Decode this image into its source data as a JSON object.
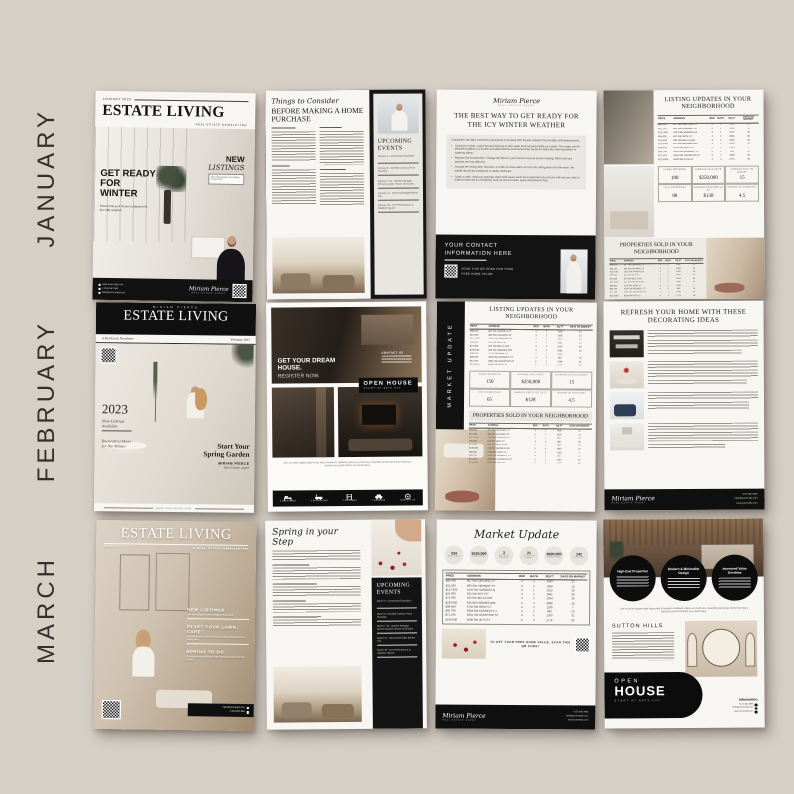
{
  "colors": {
    "background": "#d6cfc6",
    "ink": "#161616",
    "page": "#f8f6f3",
    "panel": "#e9e6e1"
  },
  "months": [
    "JANUARY",
    "FEBRUARY",
    "MARCH"
  ],
  "agent": {
    "name": "MIRIAM PIERCE",
    "signature": "Miriam Pierce",
    "title": "REAL ESTATE AGENT",
    "email": "hello@yourrealty.com",
    "phone": "+1234 567 890",
    "phone_alt": "+123 456 7890",
    "website": "www.yourrealty.com"
  },
  "table": {
    "headers": [
      "PRICE",
      "ADDRESS",
      "BED",
      "BATH",
      "SQ FT",
      "DAYS ON MARKET"
    ],
    "rows": [
      [
        "$89,000",
        "807 SW CENTRAL CT",
        "3",
        "2",
        "1400",
        "21"
      ],
      [
        "$61,200",
        "890 SW HIGHWAY ST",
        "3",
        "2",
        "1658",
        "15"
      ],
      [
        "$127,000",
        "1520 SW VARGAS LN",
        "3",
        "1",
        "1912",
        "20"
      ],
      [
        "$45,000",
        "622 SW 39TH ST",
        "4",
        "2",
        "2661",
        "30"
      ],
      [
        "$74,300",
        "920 SW BELLS AVE",
        "3",
        "2",
        "1034",
        "28"
      ],
      [
        "$230,000",
        "810 SW HERMES AVE",
        "3",
        "4",
        "3080",
        "18"
      ],
      [
        "$98,950",
        "3756 SW GRAY CT",
        "4",
        "2",
        "1109",
        "7"
      ],
      [
        "$95,700",
        "3028 SW KENNEDY CT",
        "4",
        "2",
        "983",
        "10"
      ],
      [
        "$71,100",
        "2864 SW OAKWOOD ST",
        "2",
        "1",
        "1280",
        "32"
      ],
      [
        "$219,000",
        "9509 SW 45TH ST",
        "4",
        "3",
        "2774",
        "30"
      ]
    ]
  },
  "january": {
    "cover": {
      "issue": "JANUARY 2023",
      "masthead": "ESTATE LIVING",
      "tagline": "REAL ESTATE NEWSLETTER",
      "headline": "GET READY FOR WINTER",
      "headline_sub": "Ensure that your house is prepared for the chilly weather.",
      "listings_title": "NEW",
      "listings_title2": "LISTINGS",
      "listings_sub": "The most popular new listings in your area"
    },
    "article": {
      "script_title": "Things to Consider",
      "headline": "BEFORE MAKING A HOME PURCHASE",
      "events_title": "UPCOMING EVENTS",
      "events": [
        "January 6 - Community Exposition",
        "January 8 - Monthly Common Roof Cleaning",
        "January 7-13 - Garden Heritage Homes Auction: House of Dreams",
        "January 21 - Old Annual Night Market Fair",
        "January 28 - Live Performance at Stadium Square"
      ]
    },
    "tips": {
      "headline": "THE BEST WAY TO GET READY FOR THE ICY WINTER WEATHER",
      "intro": "Companies can take numerous precautions to prepare their houses ahead of the brutally cold temperatures.",
      "bullets": [
        "Guard your pipes. Leave faucets dripping to stop water from freezing inside your pipes. The water can be allowed to gather in a bucket and afterward be used around the house for tasks like cleaning dishes or watering plants.",
        "Replace the furnace filter. Change the filters in your home to ensure proper heating. Filters that are jammed are less effective.",
        "Change the ceiling fans' direction. In order to move warm air from the ceiling down into the room, the blades should be configured to rotate clockwise.",
        "Caulk a crack. Seal any openings that could cause warm air to leak from your house and into your attic in order to keep the air circulating, such as around vents, pipes and exhaust fans."
      ],
      "contact_title": "YOUR CONTACT INFORMATION HERE",
      "qr_caption": "SCAN THIS QR CODE FOR YOUR FREE HOME VALUE!"
    },
    "market": {
      "updates_title": "LISTING UPDATES IN YOUR NEIGHBORHOOD",
      "sold_title": "PROPERTIES SOLD IN YOUR NEIGHBORHOOD",
      "stats": [
        {
          "label": "HOMES REPORTED",
          "value": "100"
        },
        {
          "label": "AVERAGE SALE PRICE",
          "value": "$250,000"
        },
        {
          "label": "AVERAGE DAYS ON MARKET",
          "value": "15"
        },
        {
          "label": "SOLD PROPERTIES",
          "value": "88"
        },
        {
          "label": "AVERAGE PRICE PER SQ FT",
          "value": "$138"
        },
        {
          "label": "MONTHS OF INVENTORY",
          "value": "4.5"
        }
      ]
    }
  },
  "february": {
    "cover": {
      "masthead_name": "MIRIAM PIERCE",
      "masthead": "ESTATE LIVING",
      "newsletter_label": "A Real Estate Newsletter",
      "issue": "February 2023",
      "year": "2023",
      "line1": "New Listings Available",
      "line2": "Decorating Ideas for the Winter",
      "feature": "Start Your Spring Garden",
      "agent_name": "MIRIAM PIERCE",
      "agent_title": "Real Estate Agent",
      "website": "www.yourrealty.com"
    },
    "open_house": {
      "headline": "GET YOUR DREAM HOUSE.",
      "sub": "REGISTER NOW.",
      "contact": "CONTACT US",
      "badge_title": "OPEN HOUSE",
      "badge_sub": "START AT $873,000",
      "caption": "Join us in this elegant style house that is located in Oakland, where we could see a beautiful and private house that has a spacious pool and interior you would enjoy.",
      "amenities": [
        "4 BEDROOMS",
        "3 BATHROOMS",
        "2 KITCHENS",
        "2 GARAGES",
        "CONTACT US"
      ]
    },
    "market": {
      "side_label": "MARKET UPDATE",
      "updates_title": "LISTING UPDATES IN YOUR NEIGHBORHOOD",
      "sold_title": "PROPERTIES SOLD IN YOUR NEIGHBORHOOD",
      "stats": [
        {
          "label": "HOMES REPORTED",
          "value": "150"
        },
        {
          "label": "AVERAGE SALE PRICE",
          "value": "$250,000"
        },
        {
          "label": "AVERAGE DAYS ON MARKET",
          "value": "15"
        },
        {
          "label": "SOLD PROPERTIES",
          "value": "65"
        },
        {
          "label": "AVERAGE PRICE PER SQ FT",
          "value": "$128"
        },
        {
          "label": "MONTHS OF INVENTORY",
          "value": "4.5"
        }
      ]
    },
    "decor": {
      "headline": "REFRESH YOUR HOME WITH THESE DECORATING IDEAS"
    }
  },
  "march": {
    "cover": {
      "masthead": "ESTATE LIVING",
      "issue": "MARCH 2023",
      "tagline": "A REAL ESTATE NEWSLETTER",
      "blocks": [
        {
          "title": "NEW LISTINGS",
          "sub": "The most popular new listings for this month"
        },
        {
          "title": "START YOUR LAWN CARE",
          "sub": "The official start of the season for lawn maintenance is finally here."
        },
        {
          "title": "SPRING TO DO",
          "sub": "Our recommended home improvement projects for this month"
        }
      ]
    },
    "article": {
      "script_title": "Spring in your Step",
      "events_title": "UPCOMING EVENTS",
      "events": [
        "March 5 - Community Exposition",
        "March 8 - Monthly Common Roof Cleaning",
        "March 7-13 - Garden Heritage Homes Auction: House of Dreams",
        "March 21 - Old Annual Night Market Fair",
        "March 30 - Live Performance at Stadium Square"
      ]
    },
    "market": {
      "script_title": "Market Update",
      "circles": [
        {
          "value": "234",
          "label": "NEW LISTINGS"
        },
        {
          "value": "$150,000",
          "label": "LOWEST PRICE"
        },
        {
          "value": "3",
          "label": "MONTHS OF INVENTORY"
        },
        {
          "value": "21",
          "label": "AVG DAYS ON MARKET"
        },
        {
          "value": "$600,000",
          "label": "HIGHEST PRICE"
        },
        {
          "value": "142",
          "label": "HOMES SOLD"
        }
      ],
      "qr_caption": "TO GET YOUR FREE HOME VALUE, SCAN THIS QR CODE!"
    },
    "open_house": {
      "circles": [
        "High-End Properties",
        "Modern & Minimalist Design",
        "Increased Value Overtime"
      ],
      "caption": "Join us in this elegant style house that is located in Oakland, where we could see a beautiful and private house that has a spacious pool and interior you would enjoy.",
      "community": "SUTTON HILLS",
      "badge_open": "OPEN",
      "badge_house": "HOUSE",
      "badge_sub": "START AT $873,000",
      "info_title": "Information"
    }
  }
}
